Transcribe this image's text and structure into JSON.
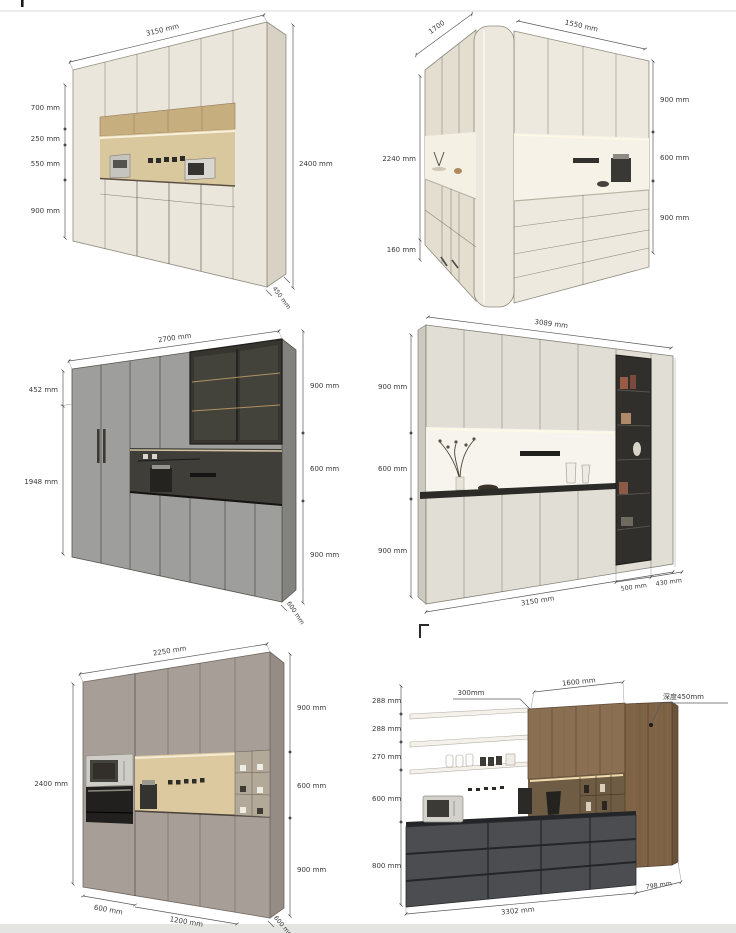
{
  "page": {
    "bg": "#ffffff",
    "top_strip_color": "#ececea",
    "bottom_strip_color": "#e4e4e2"
  },
  "colors": {
    "cream_front": "#eae6dc",
    "cream_side": "#d8d2c4",
    "wood_band": "#c7ae7e",
    "wood_backsplash": "#d9c79e",
    "gray_front": "#9e9e9c",
    "dark_niche": "#403e38",
    "taupe_front": "#a79e97",
    "charcoal_base": "#4b4d50",
    "walnut": "#8b6f53",
    "dimension_line": "#5a5a5a",
    "label_text": "#3a3a3a"
  },
  "panels": {
    "p1": {
      "title": "tall cream pantry wall unit",
      "top": "3150 mm",
      "left": [
        "700 mm",
        "250 mm",
        "550 mm",
        "900 mm"
      ],
      "right": "2400 mm",
      "depth": "450 mm"
    },
    "p2": {
      "title": "cream corner cabinet unit",
      "top_left": "1700",
      "top_right": "1550 mm",
      "left": "2240 mm",
      "left_bottom": "160 mm",
      "right": [
        "900 mm",
        "600 mm",
        "900 mm"
      ]
    },
    "p3": {
      "title": "gray coffee-station unit with fridge",
      "top": "2700 mm",
      "left": [
        "452 mm",
        "1948 mm"
      ],
      "right": [
        "900 mm",
        "600 mm",
        "900 mm"
      ],
      "depth": "600 mm"
    },
    "p4": {
      "title": "light sideboard with open bookshelf",
      "top": "3089 mm",
      "left": [
        "900 mm",
        "600 mm",
        "900 mm"
      ],
      "bottom": "3150 mm",
      "bottom_right": [
        "500 mm",
        "430 mm"
      ]
    },
    "p5": {
      "title": "taupe oven tower wall unit",
      "top": "2250 mm",
      "left": "2400 mm",
      "right": [
        "900 mm",
        "600 mm",
        "900 mm"
      ],
      "bottom": [
        "600 mm",
        "1200 mm"
      ],
      "depth": "600 mm"
    },
    "p6": {
      "title": "open-shelf kitchen run with walnut cabinets",
      "left": [
        "288 mm",
        "288 mm",
        "270 mm",
        "600 mm",
        "800 mm"
      ],
      "top": [
        "300mm",
        "1600 mm"
      ],
      "depth_note": "深度450mm",
      "bottom": [
        "3302 mm",
        "798 mm"
      ]
    }
  }
}
